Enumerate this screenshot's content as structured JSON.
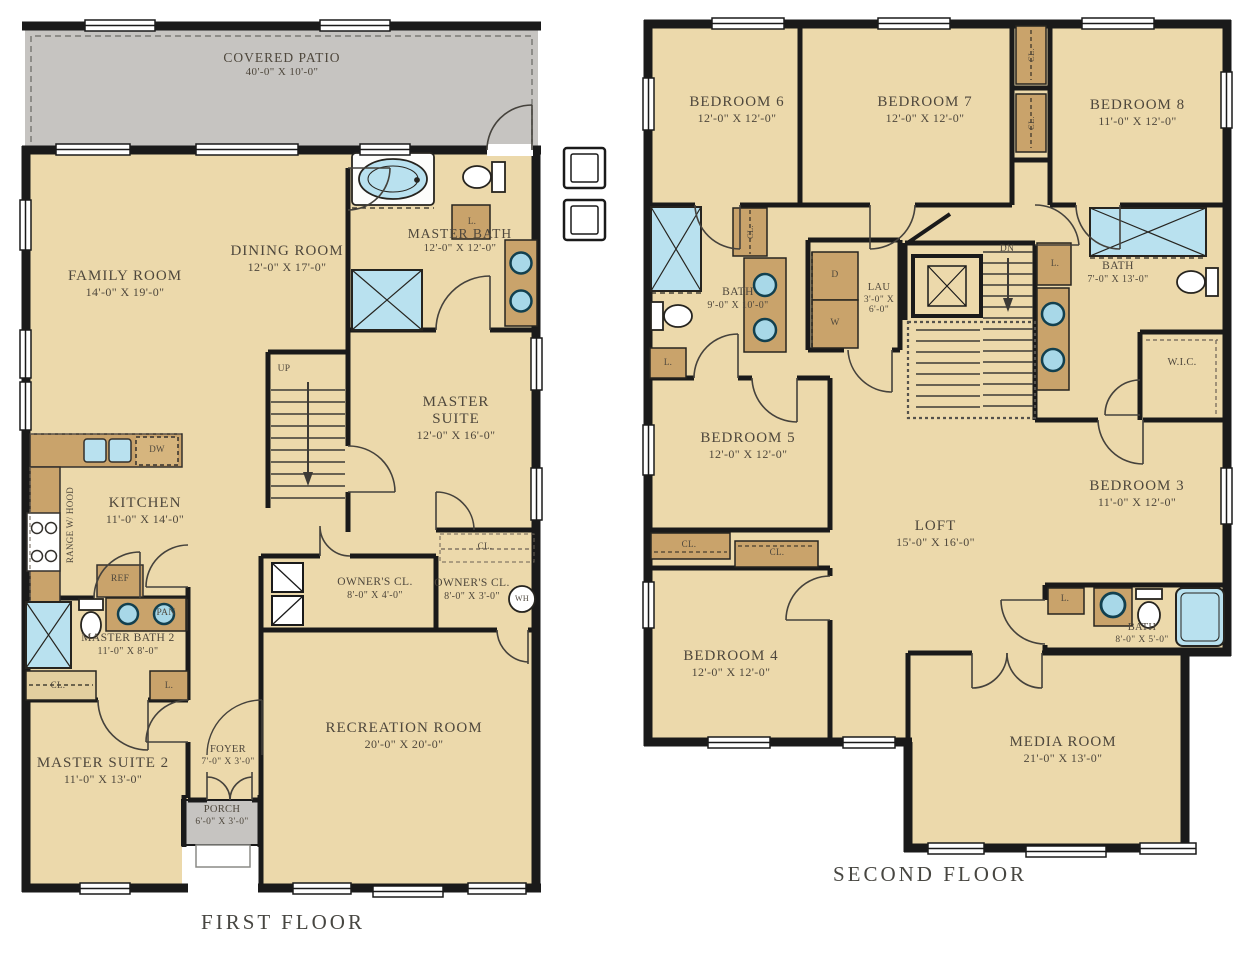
{
  "floors": {
    "first": {
      "title": "FIRST FLOOR",
      "rooms": {
        "covered_patio": {
          "name": "COVERED PATIO",
          "dims": "40'-0\" X 10'-0\""
        },
        "family_room": {
          "name": "FAMILY ROOM",
          "dims": "14'-0\" X 19'-0\""
        },
        "dining_room": {
          "name": "DINING ROOM",
          "dims": "12'-0\" X 17'-0\""
        },
        "master_bath": {
          "name": "MASTER BATH",
          "dims": "12'-0\" X 12'-0\""
        },
        "master_suite": {
          "name": "MASTER SUITE",
          "dims": "12'-0\" X 16'-0\""
        },
        "kitchen": {
          "name": "KITCHEN",
          "dims": "11'-0\" X 14'-0\""
        },
        "owners_closet_1": {
          "name": "OWNER'S CL.",
          "dims": "8'-0\" X 4'-0\""
        },
        "owners_closet_2": {
          "name": "OWNER'S CL.",
          "dims": "8'-0\" X 3'-0\""
        },
        "master_bath_2": {
          "name": "MASTER BATH 2",
          "dims": "11'-0\" X 8'-0\""
        },
        "master_suite_2": {
          "name": "MASTER SUITE 2",
          "dims": "11'-0\" X 13'-0\""
        },
        "foyer": {
          "name": "FOYER",
          "dims": "7'-0\" X 3'-0\""
        },
        "porch": {
          "name": "PORCH",
          "dims": "6'-0\" X 3'-0\""
        },
        "recreation_room": {
          "name": "RECREATION ROOM",
          "dims": "20'-0\" X 20'-0\""
        }
      },
      "annotations": {
        "up": "UP",
        "dw": "DW",
        "ref": "REF",
        "pan": "PAN",
        "range_hood": "RANGE W/ HOOD",
        "wh": "WH",
        "cl": "CL.",
        "l": "L."
      }
    },
    "second": {
      "title": "SECOND FLOOR",
      "rooms": {
        "bedroom_6": {
          "name": "BEDROOM 6",
          "dims": "12'-0\" X 12'-0\""
        },
        "bedroom_7": {
          "name": "BEDROOM 7",
          "dims": "12'-0\" X 12'-0\""
        },
        "bedroom_8": {
          "name": "BEDROOM 8",
          "dims": "11'-0\" X 12'-0\""
        },
        "bath_1": {
          "name": "BATH",
          "dims": "9'-0\" X 10'-0\""
        },
        "laundry": {
          "name": "LAU",
          "dims": "3'-0\" X 6'-0\""
        },
        "bath_2": {
          "name": "BATH",
          "dims": "7'-0\" X 13'-0\""
        },
        "wic": {
          "name": "W.I.C."
        },
        "bedroom_5": {
          "name": "BEDROOM 5",
          "dims": "12'-0\" X 12'-0\""
        },
        "loft": {
          "name": "LOFT",
          "dims": "15'-0\" X 16'-0\""
        },
        "bedroom_3": {
          "name": "BEDROOM 3",
          "dims": "11'-0\" X 12'-0\""
        },
        "bedroom_4": {
          "name": "BEDROOM 4",
          "dims": "12'-0\" X 12'-0\""
        },
        "bath_3": {
          "name": "BATH",
          "dims": "8'-0\" X 5'-0\""
        },
        "media_room": {
          "name": "MEDIA ROOM",
          "dims": "21'-0\" X 13'-0\""
        }
      },
      "annotations": {
        "dn": "DN",
        "d": "D",
        "w": "W",
        "cl": "CL.",
        "l": "L."
      }
    }
  },
  "colors": {
    "room_fill": "#ecd9ab",
    "patio_fill": "#c6c4c1",
    "cabinet_fill": "#c9a36b",
    "fixture_blue": "#b9e1ef",
    "wall": "#1a1a1a",
    "text": "#4e473c"
  }
}
